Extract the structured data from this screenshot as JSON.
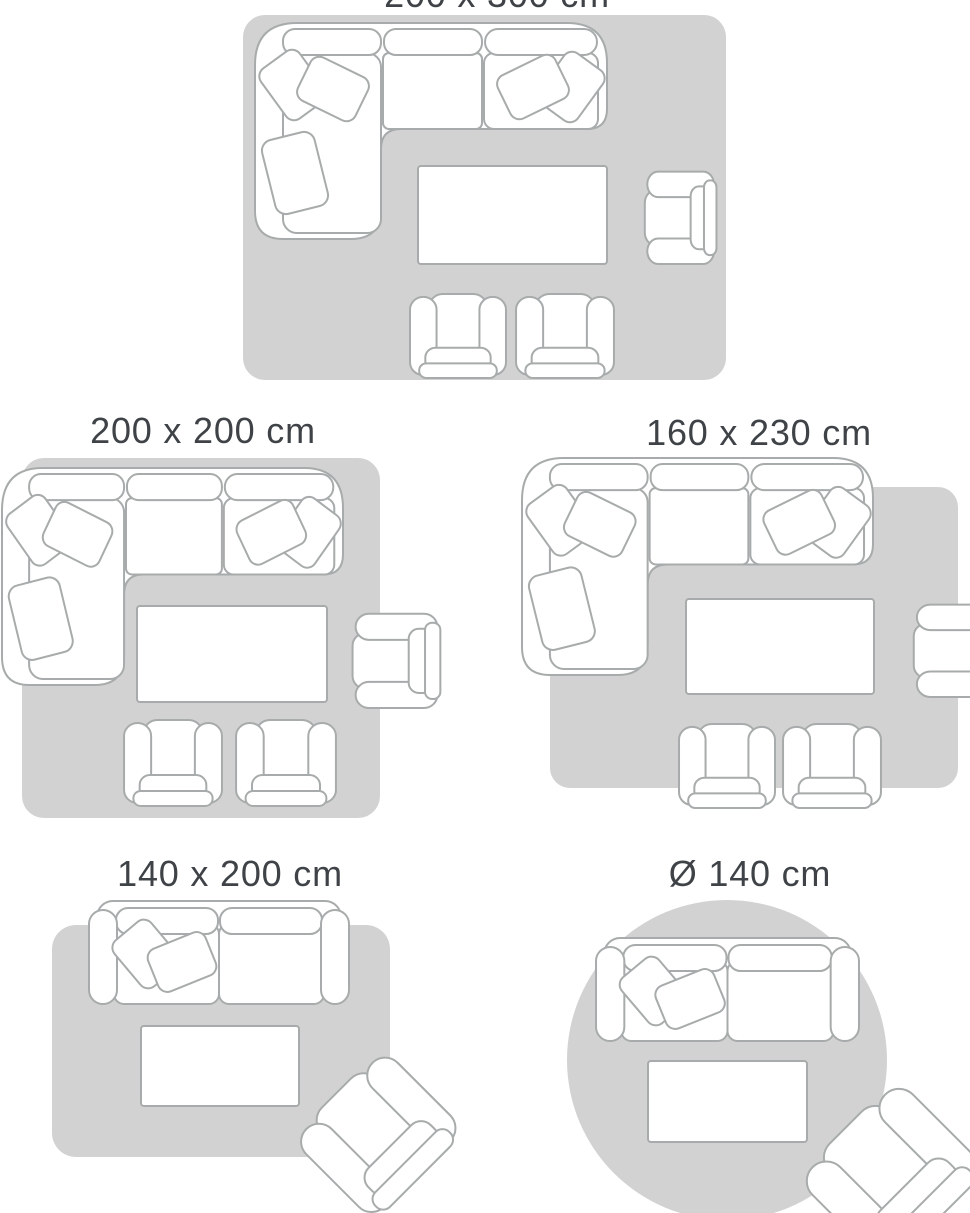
{
  "panels": [
    {
      "id": "size-200x300",
      "label": "200 x 300 cm",
      "rug_shape": "rectangle",
      "furniture": [
        "corner-sofa",
        "coffee-table",
        "armchair",
        "small-armchair",
        "small-armchair"
      ]
    },
    {
      "id": "size-200x200",
      "label": "200 x 200 cm",
      "rug_shape": "rectangle",
      "furniture": [
        "corner-sofa",
        "coffee-table",
        "armchair",
        "small-armchair",
        "small-armchair"
      ]
    },
    {
      "id": "size-160x230",
      "label": "160 x 230 cm",
      "rug_shape": "rectangle",
      "furniture": [
        "corner-sofa",
        "coffee-table",
        "armchair",
        "small-armchair",
        "small-armchair"
      ]
    },
    {
      "id": "size-140x200",
      "label": "140 x 200 cm",
      "rug_shape": "rectangle",
      "furniture": [
        "two-seater-sofa",
        "coffee-table",
        "tilted-armchair"
      ]
    },
    {
      "id": "size-round-140",
      "label": "Ø 140 cm",
      "rug_shape": "circle",
      "furniture": [
        "two-seater-sofa",
        "coffee-table",
        "tilted-armchair"
      ]
    }
  ],
  "colors": {
    "background": "#ffffff",
    "rug": "#d2d2d2",
    "outline": "#a8abab",
    "furniture_fill": "#ffffff",
    "label_text": "#3f4347"
  }
}
